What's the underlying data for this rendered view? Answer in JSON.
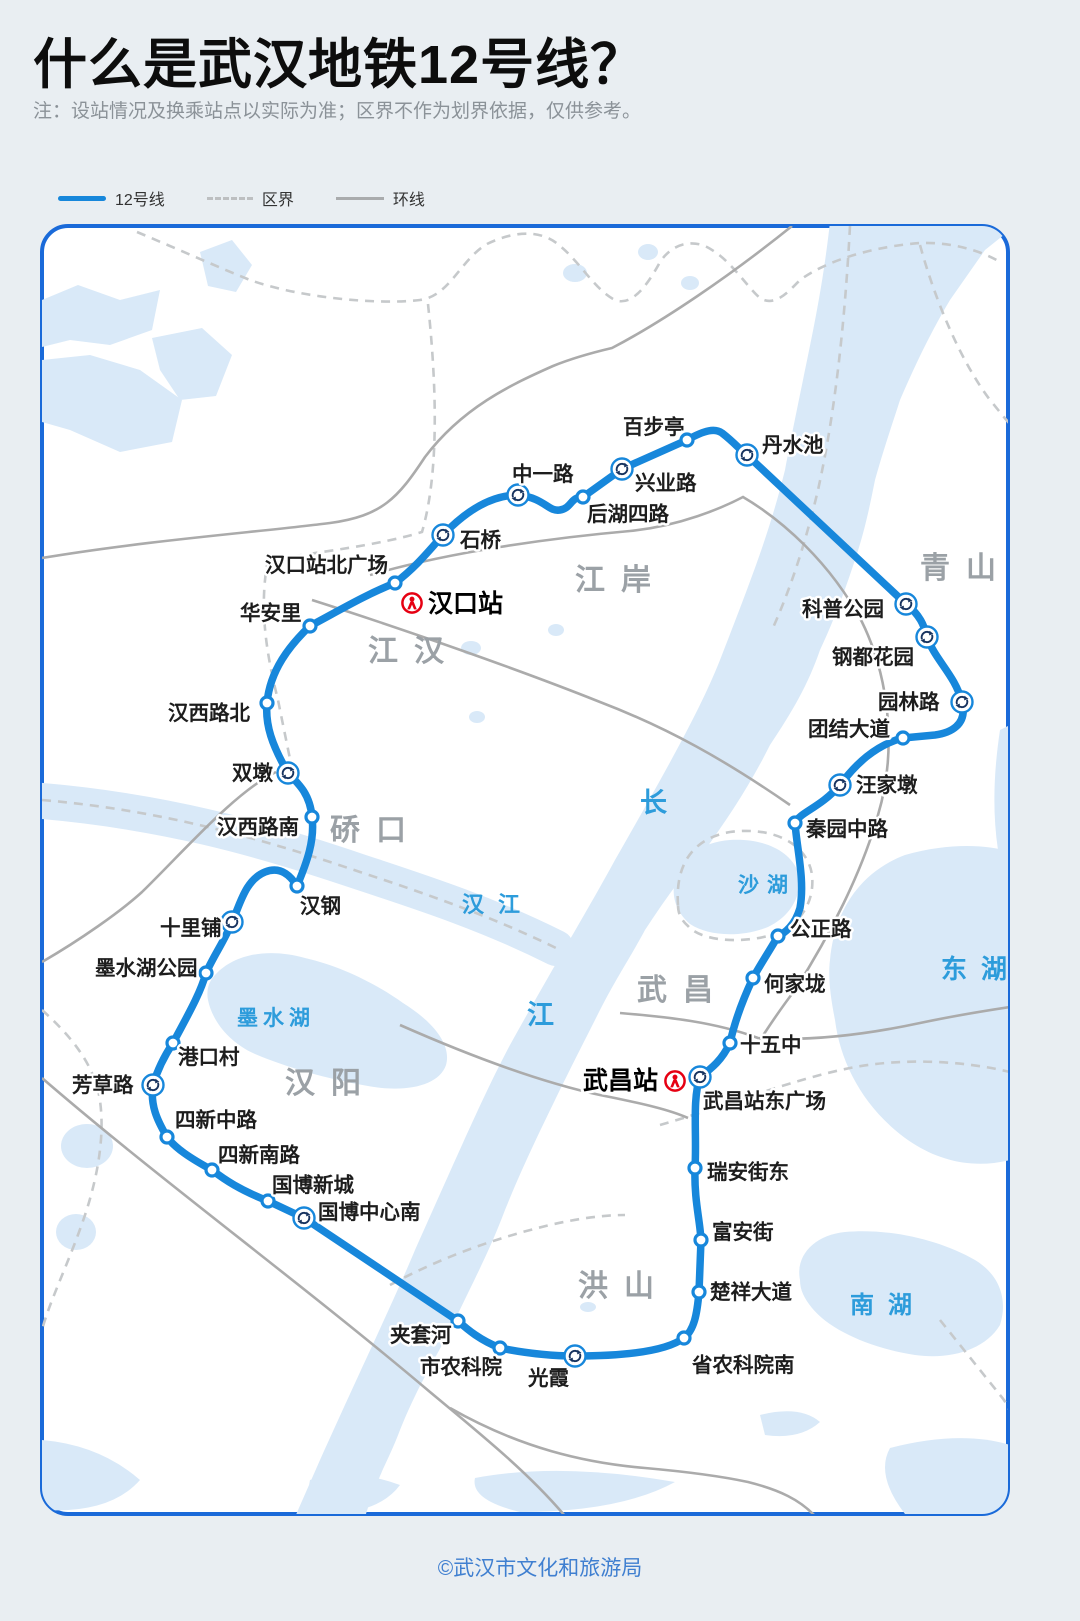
{
  "header": {
    "title": "什么是武汉地铁12号线？",
    "note": "注：设站情况及换乘站点以实际为准；区界不作为划界依据，仅供参考。"
  },
  "legend": {
    "items": [
      {
        "label": "12号线",
        "type": "line"
      },
      {
        "label": "区界",
        "type": "dashed"
      },
      {
        "label": "环线",
        "type": "solid"
      }
    ]
  },
  "colors": {
    "line": "#1787DB",
    "map_border": "#1A6AD9",
    "water": "#D9E9F8",
    "road": "#ABABAB",
    "boundary": "#C6C9CB",
    "water_text": "#2D9CDB",
    "district_text": "#9BA1A6",
    "railway_red": "#E60012"
  },
  "map": {
    "districts": [
      {
        "name": "江岸",
        "x": 575,
        "y": 590
      },
      {
        "name": "江汉",
        "x": 368,
        "y": 661
      },
      {
        "name": "硚口",
        "x": 330,
        "y": 840
      },
      {
        "name": "汉阳",
        "x": 285,
        "y": 1093
      },
      {
        "name": "武昌",
        "x": 637,
        "y": 1000
      },
      {
        "name": "洪山",
        "x": 578,
        "y": 1296
      },
      {
        "name": "青山",
        "x": 920,
        "y": 578
      }
    ],
    "water_labels": [
      {
        "name": "汉江",
        "x": 462,
        "y": 912,
        "size": 22,
        "ls": 14
      },
      {
        "name": "长",
        "x": 640,
        "y": 812,
        "size": 27,
        "ls": 0
      },
      {
        "name": "江",
        "x": 527,
        "y": 1024,
        "size": 27,
        "ls": 0
      },
      {
        "name": "墨水湖",
        "x": 237,
        "y": 1025,
        "size": 21,
        "ls": 5
      },
      {
        "name": "沙湖",
        "x": 738,
        "y": 892,
        "size": 21,
        "ls": 8
      },
      {
        "name": "东湖",
        "x": 941,
        "y": 978,
        "size": 26,
        "ls": 14
      },
      {
        "name": "南湖",
        "x": 850,
        "y": 1313,
        "size": 24,
        "ls": 14
      }
    ],
    "railway_stations": [
      {
        "name": "汉口站",
        "icon_x": 412,
        "icon_y": 603,
        "lx": 428,
        "ly": 612
      },
      {
        "name": "武昌站",
        "icon_x": 675,
        "icon_y": 1081,
        "lx": 583,
        "ly": 1089
      }
    ],
    "stations": [
      {
        "name": "汉口站北广场",
        "x": 395,
        "y": 583,
        "t": "s",
        "lx": 265,
        "ly": 572
      },
      {
        "name": "石桥",
        "x": 443,
        "y": 535,
        "t": "i",
        "lx": 460,
        "ly": 547
      },
      {
        "name": "中一路",
        "x": 518,
        "y": 495,
        "t": "i",
        "lx": 512,
        "ly": 481
      },
      {
        "name": "后湖四路",
        "x": 583,
        "y": 497,
        "t": "s",
        "lx": 587,
        "ly": 521
      },
      {
        "name": "兴业路",
        "x": 622,
        "y": 469,
        "t": "i",
        "lx": 635,
        "ly": 490
      },
      {
        "name": "百步亭",
        "x": 687,
        "y": 440,
        "t": "s",
        "lx": 623,
        "ly": 434
      },
      {
        "name": "丹水池",
        "x": 747,
        "y": 455,
        "t": "i",
        "lx": 762,
        "ly": 452
      },
      {
        "name": "科普公园",
        "x": 906,
        "y": 604,
        "t": "i",
        "lx": 802,
        "ly": 616
      },
      {
        "name": "钢都花园",
        "x": 927,
        "y": 637,
        "t": "i",
        "lx": 832,
        "ly": 664
      },
      {
        "name": "园林路",
        "x": 962,
        "y": 702,
        "t": "i",
        "lx": 878,
        "ly": 709
      },
      {
        "name": "团结大道",
        "x": 903,
        "y": 738,
        "t": "s",
        "lx": 808,
        "ly": 736
      },
      {
        "name": "汪家墩",
        "x": 840,
        "y": 785,
        "t": "i",
        "lx": 856,
        "ly": 792
      },
      {
        "name": "秦园中路",
        "x": 795,
        "y": 823,
        "t": "s",
        "lx": 806,
        "ly": 836
      },
      {
        "name": "公正路",
        "x": 778,
        "y": 936,
        "t": "s",
        "lx": 790,
        "ly": 936
      },
      {
        "name": "何家垅",
        "x": 753,
        "y": 978,
        "t": "s",
        "lx": 764,
        "ly": 991
      },
      {
        "name": "十五中",
        "x": 730,
        "y": 1043,
        "t": "s",
        "lx": 740,
        "ly": 1052
      },
      {
        "name": "武昌站东广场",
        "x": 700,
        "y": 1077,
        "t": "i",
        "lx": 703,
        "ly": 1108
      },
      {
        "name": "瑞安街东",
        "x": 695,
        "y": 1168,
        "t": "s",
        "lx": 707,
        "ly": 1179
      },
      {
        "name": "富安街",
        "x": 701,
        "y": 1240,
        "t": "s",
        "lx": 712,
        "ly": 1239
      },
      {
        "name": "楚祥大道",
        "x": 699,
        "y": 1292,
        "t": "s",
        "lx": 710,
        "ly": 1299
      },
      {
        "name": "省农科院南",
        "x": 684,
        "y": 1338,
        "t": "s",
        "lx": 692,
        "ly": 1372
      },
      {
        "name": "光霞",
        "x": 575,
        "y": 1356,
        "t": "i",
        "lx": 528,
        "ly": 1385
      },
      {
        "name": "市农科院",
        "x": 500,
        "y": 1348,
        "t": "s",
        "lx": 420,
        "ly": 1374
      },
      {
        "name": "夹套河",
        "x": 458,
        "y": 1321,
        "t": "s",
        "lx": 390,
        "ly": 1342
      },
      {
        "name": "国博中心南",
        "x": 304,
        "y": 1218,
        "t": "i",
        "lx": 318,
        "ly": 1219
      },
      {
        "name": "国博新城",
        "x": 268,
        "y": 1201,
        "t": "s",
        "lx": 272,
        "ly": 1192
      },
      {
        "name": "四新南路",
        "x": 212,
        "y": 1170,
        "t": "s",
        "lx": 218,
        "ly": 1162
      },
      {
        "name": "四新中路",
        "x": 167,
        "y": 1137,
        "t": "s",
        "lx": 175,
        "ly": 1127
      },
      {
        "name": "芳草路",
        "x": 153,
        "y": 1085,
        "t": "i",
        "lx": 72,
        "ly": 1092
      },
      {
        "name": "港口村",
        "x": 173,
        "y": 1043,
        "t": "s",
        "lx": 178,
        "ly": 1064
      },
      {
        "name": "墨水湖公园",
        "x": 206,
        "y": 973,
        "t": "s",
        "lx": 95,
        "ly": 975
      },
      {
        "name": "十里铺",
        "x": 232,
        "y": 922,
        "t": "i",
        "lx": 160,
        "ly": 935
      },
      {
        "name": "汉钢",
        "x": 297,
        "y": 886,
        "t": "s",
        "lx": 300,
        "ly": 913
      },
      {
        "name": "汉西路南",
        "x": 312,
        "y": 817,
        "t": "s",
        "lx": 217,
        "ly": 834
      },
      {
        "name": "双墩",
        "x": 288,
        "y": 773,
        "t": "i",
        "lx": 232,
        "ly": 780
      },
      {
        "name": "汉西路北",
        "x": 267,
        "y": 703,
        "t": "s",
        "lx": 168,
        "ly": 720
      },
      {
        "name": "华安里",
        "x": 310,
        "y": 626,
        "t": "s",
        "lx": 240,
        "ly": 620
      }
    ]
  },
  "footer": {
    "credit": "©武汉市文化和旅游局"
  }
}
